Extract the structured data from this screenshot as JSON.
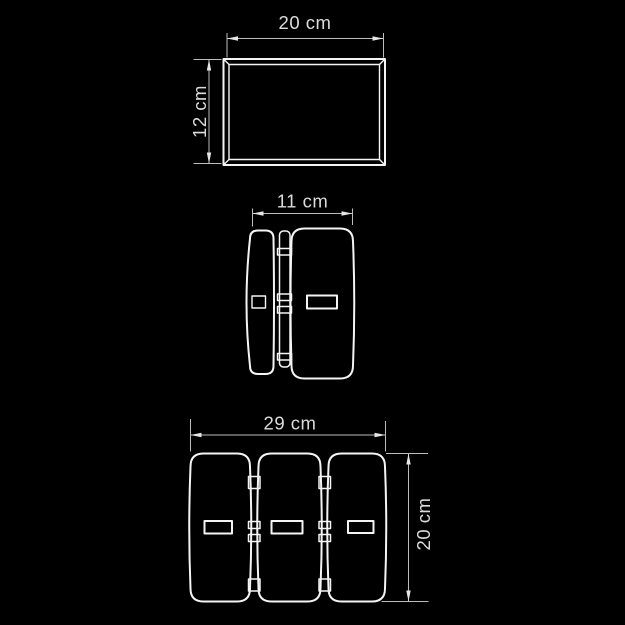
{
  "drawing": {
    "kind": "technical-dimension-drawing",
    "views": {
      "top": {
        "width_label": "20 cm",
        "height_label": "12 cm"
      },
      "side": {
        "depth_label": "11 cm"
      },
      "front": {
        "width_label": "29 cm",
        "height_label": "20 cm"
      }
    }
  },
  "colors": {
    "background": "#000000",
    "outline": "#f4f4f4",
    "dimension": "#bdbdbd",
    "arrow": "#e6e6e6",
    "label": "#dcdcdc"
  }
}
